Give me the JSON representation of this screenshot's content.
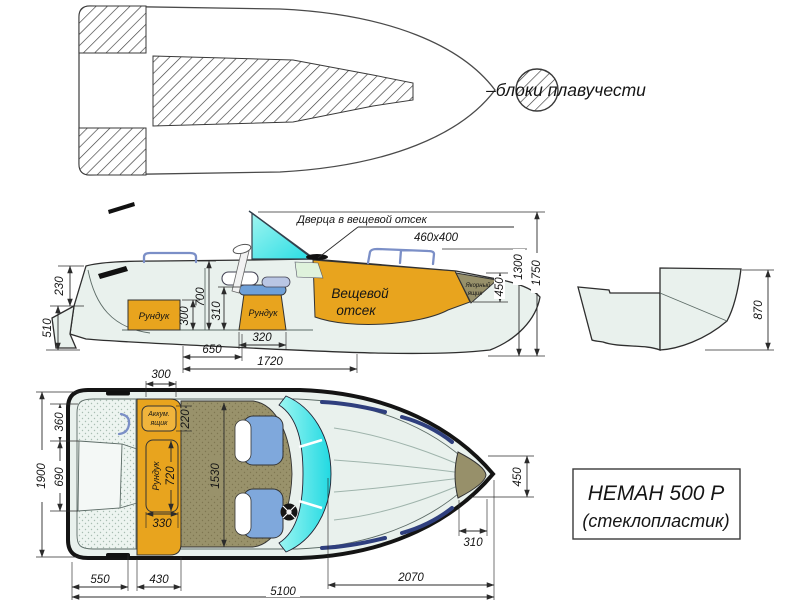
{
  "legend": {
    "label": "–блоки плавучести"
  },
  "title_box": {
    "line1": "НЕМАН 500 Р",
    "line2": "(стеклопластик)"
  },
  "colors": {
    "locker_orange": "#E8A41E",
    "anchor_khaki": "#97906A",
    "seat_blue": "#7FA8DC",
    "windshield_cyan": "#2EDDE5",
    "hull_fill": "#E9F1ED"
  },
  "side_view": {
    "door_label": "Дверца в вещевой отсек",
    "door_size": "460х400",
    "gear_line1": "Вещевой",
    "gear_line2": "отсек",
    "anchor_line1": "Якорный",
    "anchor_line2": "ящик",
    "aft_locker": "Рундук",
    "seat_locker": "Рундук",
    "dim_230": "230",
    "dim_510": "510",
    "dim_300": "300",
    "dim_700": "700",
    "dim_310": "310",
    "dim_320": "320",
    "dim_650": "650",
    "dim_1720": "1720",
    "dim_450": "450",
    "dim_1300": "1300",
    "dim_1750": "1750"
  },
  "transom_detail": {
    "dim_870": "870"
  },
  "plan_view": {
    "battery_line1": "Аккум.",
    "battery_line2": "ящик",
    "locker_label": "Рундук",
    "dim_1900": "1900",
    "dim_360": "360",
    "dim_690": "690",
    "dim_300": "300",
    "dim_220": "220",
    "dim_720": "720",
    "dim_330": "330",
    "dim_1530": "1530",
    "dim_450": "450",
    "dim_310": "310",
    "dim_550": "550",
    "dim_430": "430",
    "dim_5100": "5100",
    "dim_2070": "2070"
  }
}
